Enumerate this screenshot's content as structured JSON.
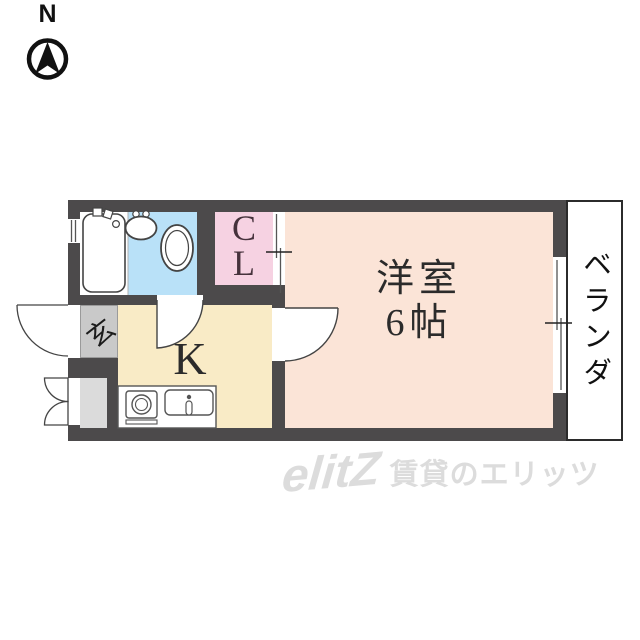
{
  "compass": {
    "north_label": "N"
  },
  "rooms": {
    "western_room": {
      "name_label": "洋室",
      "size_label": "6帖"
    },
    "kitchen": {
      "label": "K"
    },
    "closet": {
      "label": "CL"
    },
    "entrance": {
      "label": "玄"
    },
    "veranda": {
      "label": "ベランダ"
    }
  },
  "watermark": {
    "logo": "elitZ",
    "text": "賃貸のエリッツ"
  },
  "colors": {
    "wall": "#4c4a4b",
    "western_room": "#fbe4d7",
    "kitchen": "#f9ebc6",
    "closet": "#f6d2e2",
    "bathroom": "#b9e1f8",
    "entrance_floor": "#c9c9c9",
    "storage_floor": "#dbdbdb",
    "watermark": "#dcdcdc",
    "line": "#444444"
  }
}
